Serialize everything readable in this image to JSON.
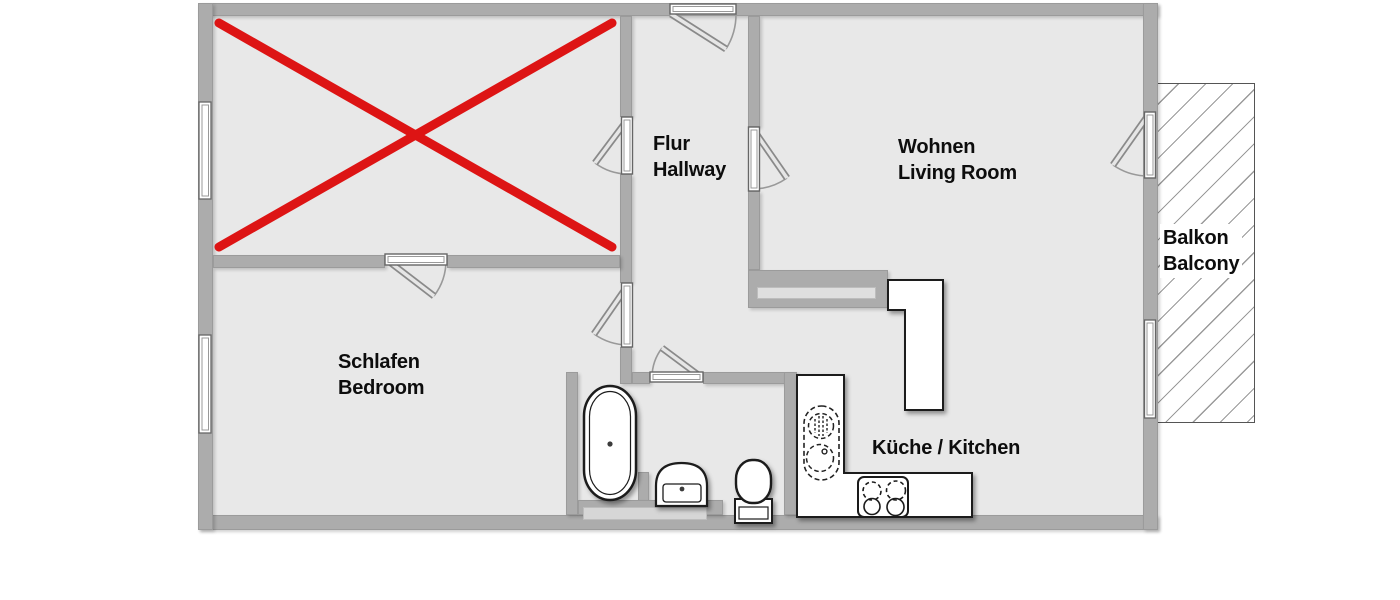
{
  "colors": {
    "wall": "#acacac",
    "floor": "#e8e8e8",
    "fixture_outline": "#1a1a1a",
    "cross_mark": "#dd1414",
    "balcony_hatch": "#9a9a9a",
    "label_text": "#0d0d0d",
    "background": "#ffffff"
  },
  "rooms": {
    "hallway": {
      "name_de": "Flur",
      "name_en": "Hallway"
    },
    "living": {
      "name_de": "Wohnen",
      "name_en": "Living Room"
    },
    "bedroom": {
      "name_de": "Schlafen",
      "name_en": "Bedroom"
    },
    "kitchen": {
      "label": "Küche / Kitchen"
    },
    "balcony": {
      "name_de": "Balkon",
      "name_en": "Balcony"
    },
    "crossed_room": {
      "marker": "red-cross"
    }
  },
  "fixtures": [
    "bathtub",
    "washbasin",
    "toilet",
    "kitchen-sink",
    "stove",
    "kitchen-counter",
    "kitchen-island"
  ],
  "openings": {
    "doors": 7,
    "windows": 3
  }
}
